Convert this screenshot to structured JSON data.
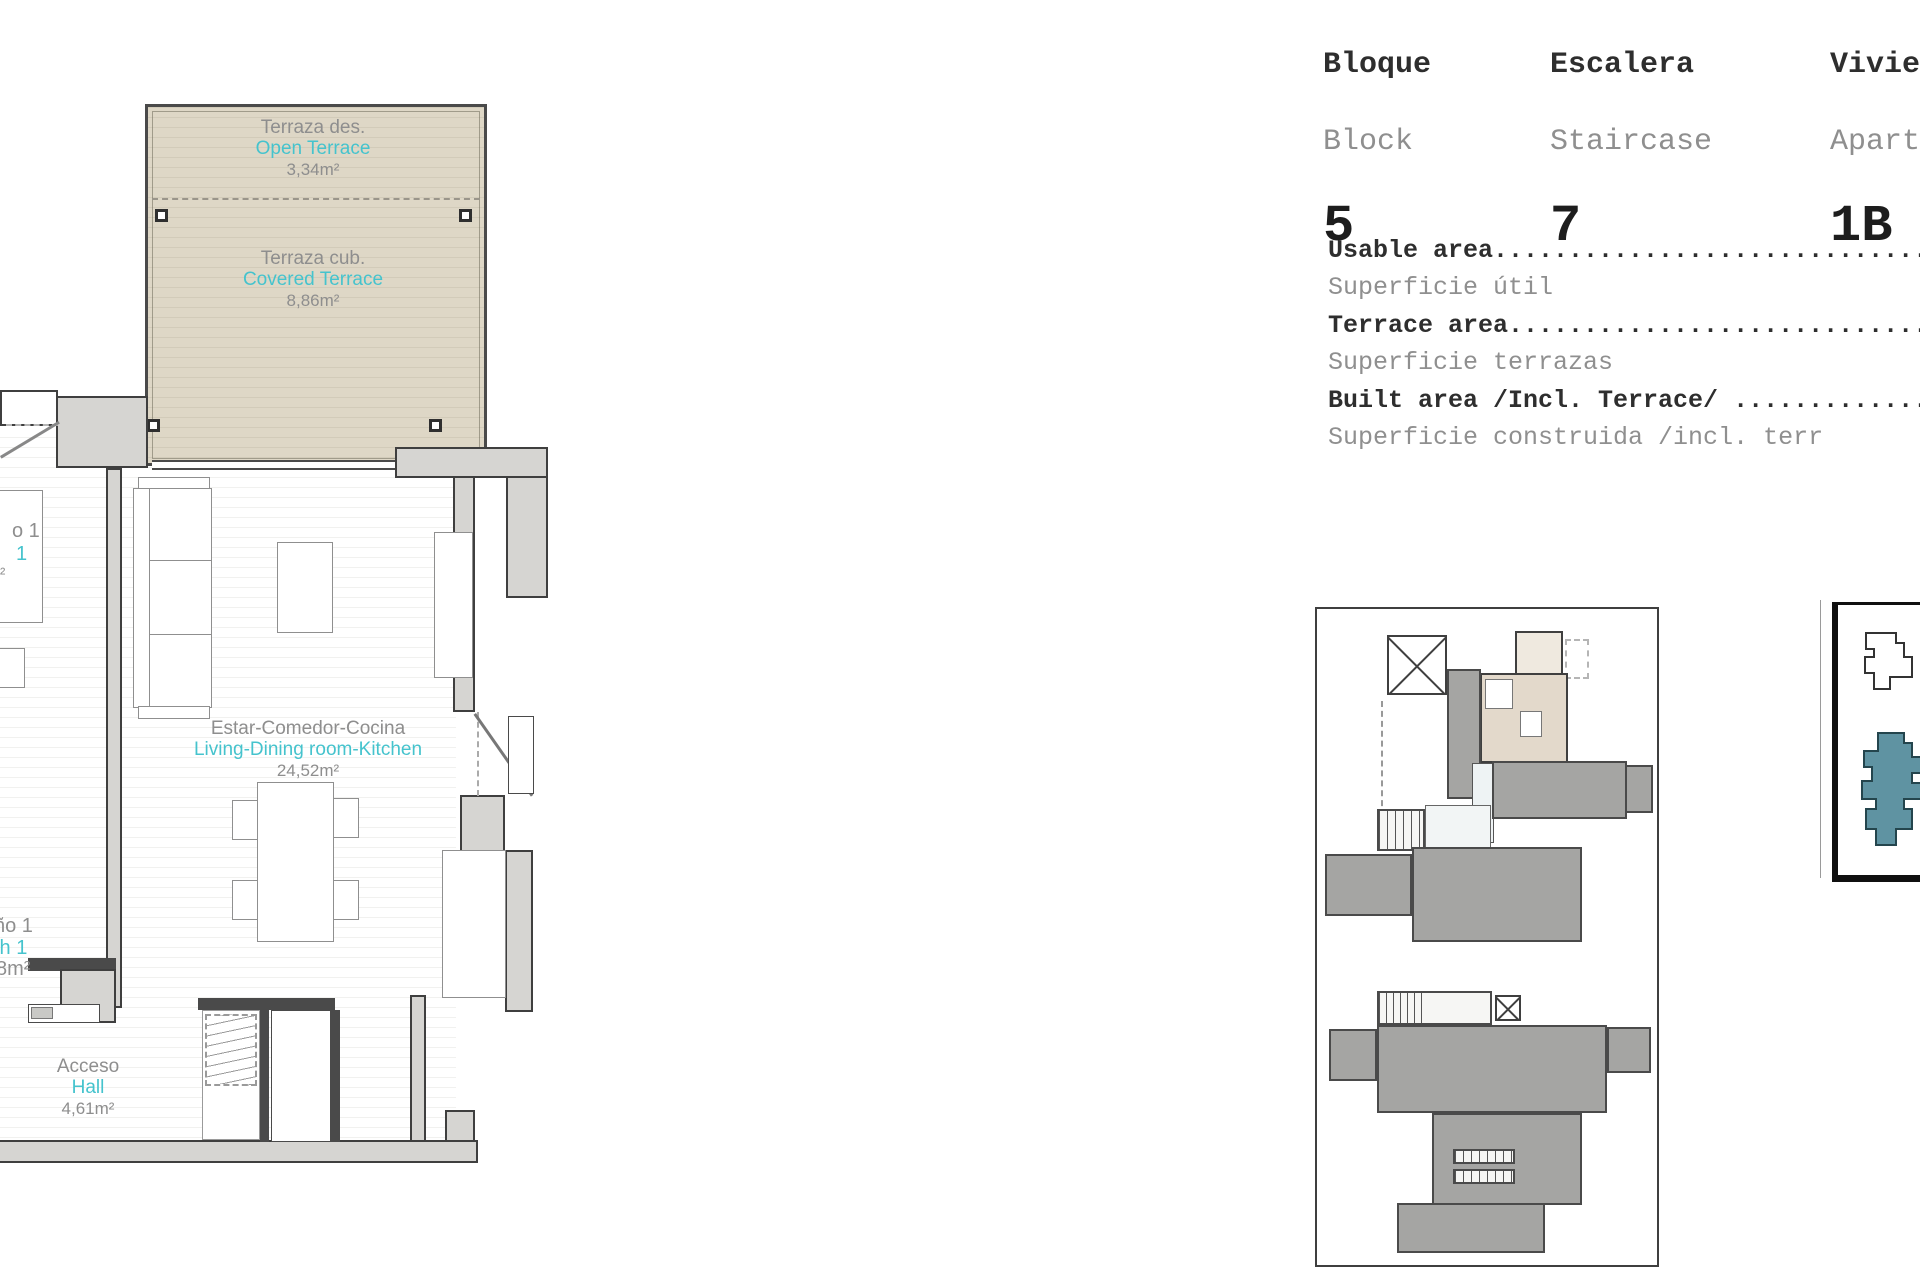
{
  "header": {
    "columns": [
      {
        "label_es": "Bloque",
        "label_en": "Block",
        "value": "5"
      },
      {
        "label_es": "Escalera",
        "label_en": "Staircase",
        "value": "7"
      },
      {
        "label_es": "Vivie",
        "label_en": "Apart",
        "value": "1B"
      }
    ]
  },
  "areas": {
    "rows": [
      {
        "en": "Usable area..............................",
        "es": "Superficie útil"
      },
      {
        "en": "Terrace area.............................",
        "es": "Superficie terrazas"
      },
      {
        "en": "Built area /Incl. Terrace/ ..............",
        "es": "Superficie construida /incl. terr"
      }
    ]
  },
  "plan": {
    "labels": {
      "open_terrace": {
        "es": "Terraza des.",
        "en": "Open Terrace",
        "area": "3,34m²"
      },
      "covered_terrace": {
        "es": "Terraza cub.",
        "en": "Covered Terrace",
        "area": "8,86m²"
      },
      "living": {
        "es": "Estar-Comedor-Cocina",
        "en": "Living-Dining room-Kitchen",
        "area": "24,52m²"
      },
      "hall": {
        "es": "Acceso",
        "en": "Hall",
        "area": "4,61m²"
      },
      "bedroom_fragment": {
        "es": "o 1",
        "en": "1",
        "area": "²"
      },
      "bath_fragment": {
        "es": "ño 1",
        "en": "th 1",
        "area": "8m²"
      }
    }
  },
  "colors": {
    "accent_cyan": "#45c3cd",
    "terrace_beige": "#ded7c6",
    "wall_gray": "#d6d5d2",
    "keyplan_gray": "#a5a5a3",
    "map_teal": "#5f93a2"
  }
}
